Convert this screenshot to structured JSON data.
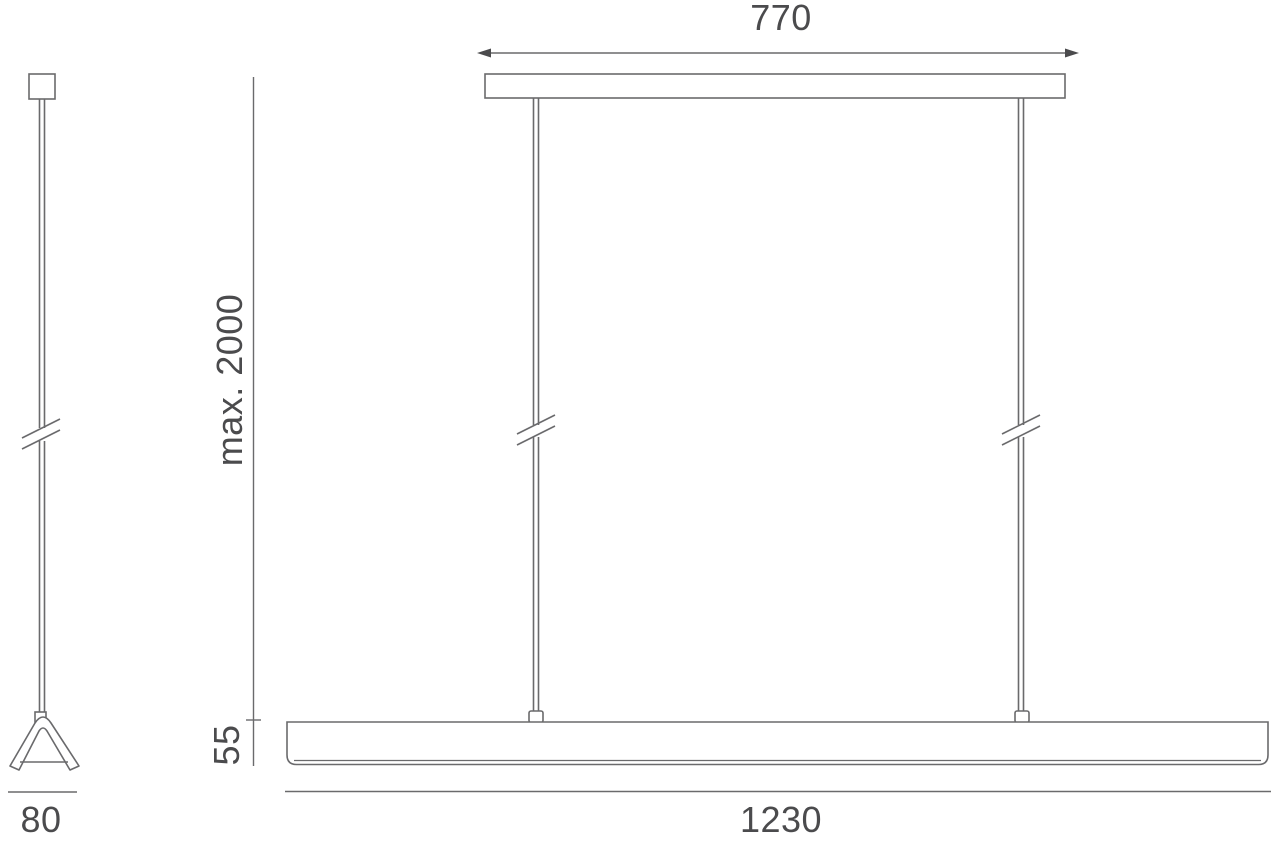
{
  "drawing": {
    "description": "Suspended linear pendant lamp dimension drawing, side view and front view",
    "colors": {
      "line": "#6a6a6c",
      "text": "#4b4b4d",
      "background": "#ffffff"
    },
    "labels": {
      "canopy_width": "770",
      "max_suspension_height": "max. 2000",
      "body_height": "55",
      "body_length": "1230",
      "profile_width": "80"
    },
    "views": {
      "side_view": "single cable with ceiling mount, cable break symbol, triangular lamp profile, width 80",
      "front_view": "canopy width 770, two suspension cables max. 2000, lamp body length 1230, body height 55"
    }
  }
}
